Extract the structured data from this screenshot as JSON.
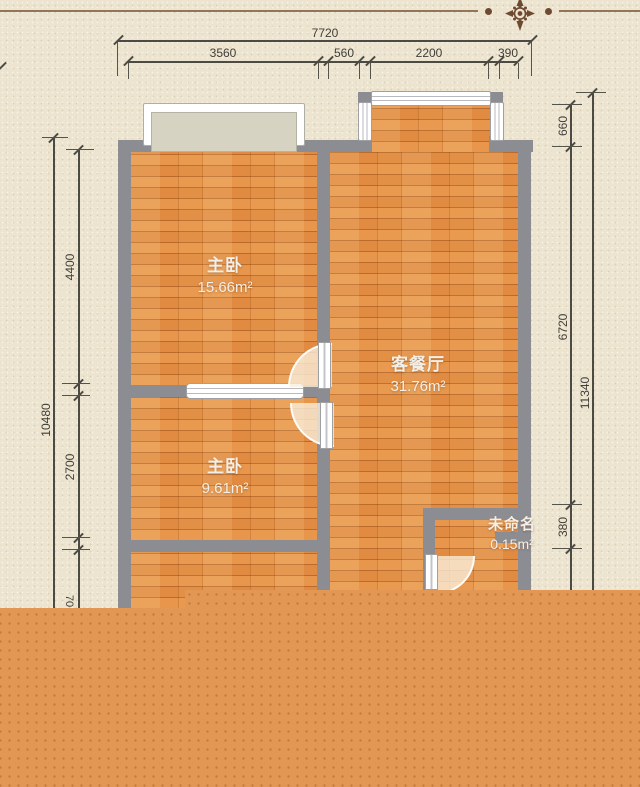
{
  "plan": {
    "rooms": [
      {
        "id": "bedroom-1",
        "name": "主卧",
        "area": "15.66m²"
      },
      {
        "id": "bedroom-2",
        "name": "主卧",
        "area": "9.61m²"
      },
      {
        "id": "living-dining",
        "name": "客餐厅",
        "area": "31.76m²"
      },
      {
        "id": "unnamed",
        "name": "未命名",
        "area": "0.15m²"
      }
    ]
  },
  "dimensions": {
    "top": {
      "total": "7720",
      "segments": [
        "3560",
        "560",
        "2200",
        "390"
      ]
    },
    "left": {
      "total": "10480",
      "segments": [
        "4400",
        "2700"
      ],
      "partial": "70"
    },
    "right": {
      "total": "11340",
      "segments": [
        "660",
        "6720",
        "380"
      ]
    }
  },
  "colors": {
    "background": "#ece4cf",
    "wall": "#8c8d92",
    "floor_wood": "#e08b41",
    "bottom_overlay": "#e29754",
    "deco_line": "#95755a",
    "ornament": "#6f4a33",
    "dimension_line": "#4b4a43",
    "room_label": "#f2efe8"
  }
}
